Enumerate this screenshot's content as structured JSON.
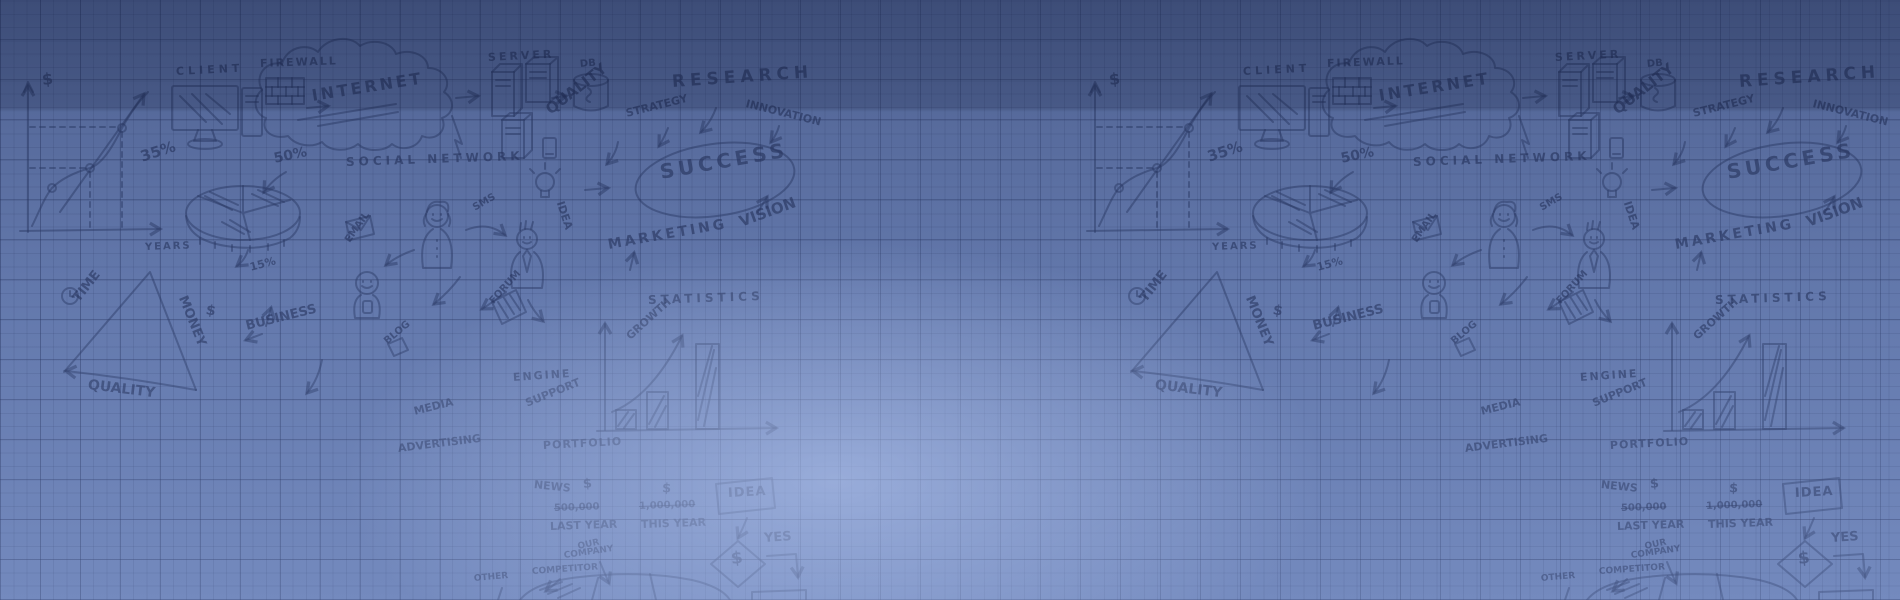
{
  "banner": {
    "width_px": 1900,
    "height_px": 600,
    "description": "hand-drawn business sketch background on blue graph paper, pattern repeated horizontally"
  },
  "colors": {
    "paper_blue": "#6a80b4",
    "grid_line": "#202c56",
    "sketch_ink": "#2b3a66",
    "center_glow": "#bccef6",
    "top_shade": "#101a3c"
  },
  "doodle": {
    "tile_offset_px": 1067,
    "texts": [
      {
        "name": "label-axis-dollar",
        "text": "$",
        "x": 42,
        "y": 72,
        "size": 16,
        "rot": -6
      },
      {
        "name": "label-client",
        "text": "CLIENT",
        "x": 176,
        "y": 66,
        "size": 11,
        "rot": -3,
        "spacing": 4
      },
      {
        "name": "label-firewall",
        "text": "FIREWALL",
        "x": 260,
        "y": 58,
        "size": 11,
        "rot": -2,
        "spacing": 2
      },
      {
        "name": "label-internet",
        "text": "INTERNET",
        "x": 312,
        "y": 88,
        "size": 16,
        "rot": -9,
        "spacing": 3
      },
      {
        "name": "label-server",
        "text": "SERVER",
        "x": 488,
        "y": 52,
        "size": 11,
        "rot": -3,
        "spacing": 3
      },
      {
        "name": "label-db",
        "text": "DB",
        "x": 580,
        "y": 60,
        "size": 10,
        "rot": -5
      },
      {
        "name": "label-50-percent",
        "text": "50%",
        "x": 274,
        "y": 152,
        "size": 14,
        "rot": -12
      },
      {
        "name": "label-35-percent",
        "text": "35%",
        "x": 141,
        "y": 150,
        "size": 15,
        "rot": -18
      },
      {
        "name": "label-social-network",
        "text": "SOCIAL NETWORK",
        "x": 346,
        "y": 156,
        "size": 12,
        "rot": -2,
        "spacing": 4
      },
      {
        "name": "label-research",
        "text": "RESEARCH",
        "x": 672,
        "y": 74,
        "size": 17,
        "rot": -4,
        "spacing": 5
      },
      {
        "name": "label-quality-top",
        "text": "QUALITY",
        "x": 548,
        "y": 104,
        "size": 15,
        "rot": -38
      },
      {
        "name": "label-strategy",
        "text": "STRATEGY",
        "x": 626,
        "y": 108,
        "size": 11,
        "rot": -14
      },
      {
        "name": "label-innovation",
        "text": "INNOVATION",
        "x": 746,
        "y": 98,
        "size": 11,
        "rot": 14
      },
      {
        "name": "label-success",
        "text": "SUCCESS",
        "x": 660,
        "y": 162,
        "size": 20,
        "rot": -10,
        "spacing": 4
      },
      {
        "name": "label-vision",
        "text": "VISION",
        "x": 740,
        "y": 215,
        "size": 15,
        "rot": -20
      },
      {
        "name": "label-marketing",
        "text": "MARKETING",
        "x": 608,
        "y": 238,
        "size": 14,
        "rot": -10,
        "spacing": 3
      },
      {
        "name": "label-statistics",
        "text": "STATISTICS",
        "x": 648,
        "y": 294,
        "size": 12,
        "rot": -2,
        "spacing": 4
      },
      {
        "name": "label-growth",
        "text": "GROWTH",
        "x": 628,
        "y": 332,
        "size": 11,
        "rot": -42
      },
      {
        "name": "label-years",
        "text": "YEARS",
        "x": 145,
        "y": 243,
        "size": 10,
        "rot": -2,
        "spacing": 2
      },
      {
        "name": "label-15-percent",
        "text": "15%",
        "x": 250,
        "y": 262,
        "size": 11,
        "rot": -15
      },
      {
        "name": "label-time",
        "text": "TIME",
        "x": 76,
        "y": 294,
        "size": 13,
        "rot": -52
      },
      {
        "name": "label-money",
        "text": "MONEY",
        "x": 182,
        "y": 290,
        "size": 13,
        "rot": 68
      },
      {
        "name": "label-money-dollar",
        "text": "$",
        "x": 206,
        "y": 303,
        "size": 14,
        "rot": 10
      },
      {
        "name": "label-business",
        "text": "BUSINESS",
        "x": 246,
        "y": 320,
        "size": 13,
        "rot": -14
      },
      {
        "name": "label-quality-bottom",
        "text": "QUALITY",
        "x": 88,
        "y": 378,
        "size": 14,
        "rot": 7
      },
      {
        "name": "label-email",
        "text": "EMAIL",
        "x": 348,
        "y": 237,
        "size": 10,
        "rot": -55
      },
      {
        "name": "label-sms",
        "text": "SMS",
        "x": 474,
        "y": 204,
        "size": 10,
        "rot": -30
      },
      {
        "name": "label-idea-vertical",
        "text": "IDEA",
        "x": 560,
        "y": 196,
        "size": 11,
        "rot": 72
      },
      {
        "name": "label-forum",
        "text": "FORUM",
        "x": 492,
        "y": 298,
        "size": 10,
        "rot": -48
      },
      {
        "name": "label-blog",
        "text": "BLOG",
        "x": 386,
        "y": 338,
        "size": 10,
        "rot": -40
      },
      {
        "name": "label-media",
        "text": "MEDIA",
        "x": 414,
        "y": 406,
        "size": 11,
        "rot": -14
      },
      {
        "name": "label-advertising",
        "text": "ADVERTISING",
        "x": 398,
        "y": 443,
        "size": 11,
        "rot": -7
      },
      {
        "name": "label-engine",
        "text": "ENGINE",
        "x": 513,
        "y": 372,
        "size": 11,
        "rot": -4,
        "spacing": 2
      },
      {
        "name": "label-support",
        "text": "SUPPORT",
        "x": 526,
        "y": 398,
        "size": 11,
        "rot": -22
      },
      {
        "name": "label-portfolio",
        "text": "PORTFOLIO",
        "x": 543,
        "y": 440,
        "size": 11,
        "rot": -3,
        "spacing": 1
      },
      {
        "name": "label-news",
        "text": "NEWS",
        "x": 534,
        "y": 479,
        "size": 11,
        "rot": 6
      },
      {
        "name": "label-news-dollar-1",
        "text": "$",
        "x": 583,
        "y": 478,
        "size": 13,
        "rot": -5
      },
      {
        "name": "label-news-dollar-2",
        "text": "$",
        "x": 662,
        "y": 482,
        "size": 13,
        "rot": 3
      },
      {
        "name": "label-amount-last-year",
        "text": "500,000",
        "x": 554,
        "y": 504,
        "size": 10,
        "rot": -2,
        "strike": true
      },
      {
        "name": "label-last-year",
        "text": "LAST YEAR",
        "x": 550,
        "y": 521,
        "size": 11,
        "rot": -2
      },
      {
        "name": "label-amount-this-year",
        "text": "1,000,000",
        "x": 639,
        "y": 502,
        "size": 10,
        "rot": -2,
        "strike": true
      },
      {
        "name": "label-this-year",
        "text": "THIS YEAR",
        "x": 641,
        "y": 519,
        "size": 11,
        "rot": -2
      },
      {
        "name": "label-our",
        "text": "OUR",
        "x": 578,
        "y": 543,
        "size": 9,
        "rot": -12
      },
      {
        "name": "label-company",
        "text": "COMPANY",
        "x": 564,
        "y": 552,
        "size": 9,
        "rot": -8
      },
      {
        "name": "label-competitor",
        "text": "COMPETITOR",
        "x": 532,
        "y": 568,
        "size": 9,
        "rot": -4
      },
      {
        "name": "label-other",
        "text": "OTHER",
        "x": 474,
        "y": 575,
        "size": 9,
        "rot": -5
      },
      {
        "name": "label-idea-box",
        "text": "IDEA",
        "x": 728,
        "y": 487,
        "size": 13,
        "rot": -3,
        "spacing": 1
      },
      {
        "name": "label-diamond-dollar",
        "text": "$",
        "x": 731,
        "y": 551,
        "size": 17,
        "rot": -6
      },
      {
        "name": "label-yes",
        "text": "YES",
        "x": 764,
        "y": 532,
        "size": 13,
        "rot": -4
      }
    ]
  }
}
